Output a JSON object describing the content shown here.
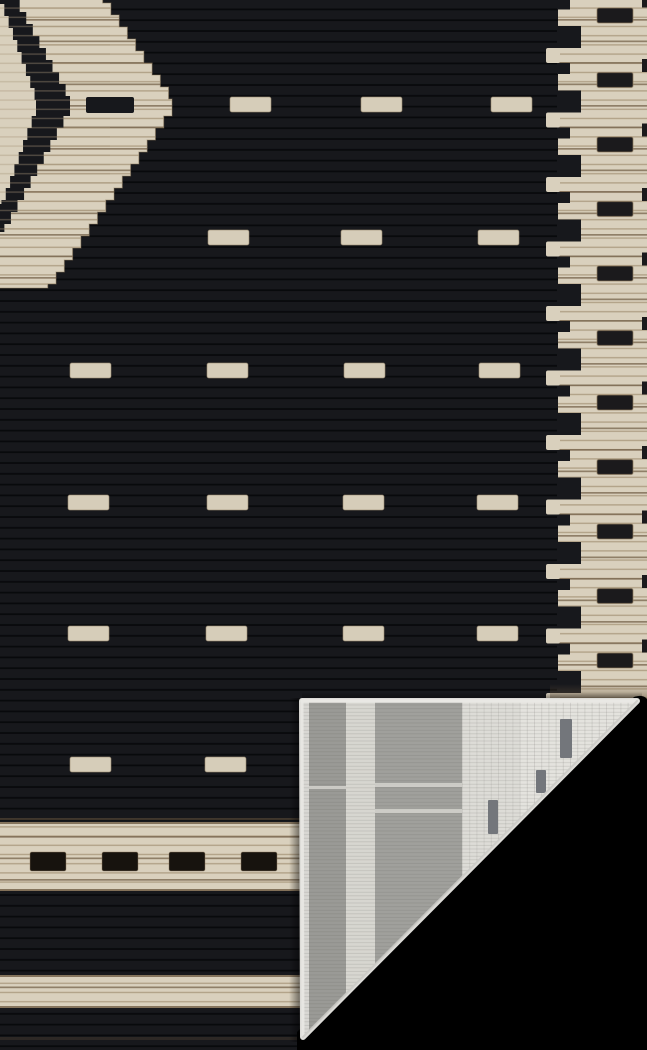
{
  "scene": {
    "type": "product-photo",
    "subject": "Black and cream geometric flat-weave area rug, bottom-right corner folded over revealing gray woven backing on a black floor",
    "background_color": "#000000",
    "image_width": 647,
    "image_height": 1050
  },
  "palette": {
    "field": "#17181c",
    "rib": "#07080a",
    "cream": "#d9d0bd",
    "cream_bright": "#e0d8c6",
    "stitch_light": "#a8967b",
    "stitch_dark": "#6f5d45",
    "border_black": "#1b1a1c",
    "dash_cream": "#d6cdb9",
    "dash_edge": "#9b8a6f",
    "band_dash_black": "#17130e",
    "halo_tan": "#8f7b5e",
    "back_edge": "#e9e8e4",
    "back_gray": "#9a9a96",
    "back_gray_wide": "#a0a09c",
    "back_light": "#d7d6d0",
    "back_white": "#e4e3de",
    "back_grid": "#c6c5c0",
    "back_dark_rect": "#73767b",
    "hyp_edge": "#cbcac6",
    "accent_brown": "#3f372e"
  },
  "field_texture": {
    "rib_spacing": 10.8,
    "rib_thickness": 1.8
  },
  "field_dashes": {
    "size": {
      "w": 41,
      "h": 15
    },
    "rows": [
      {
        "y": 97,
        "xs": [
          230,
          361,
          491
        ]
      },
      {
        "y": 230,
        "xs": [
          208,
          341,
          478
        ]
      },
      {
        "y": 363,
        "xs": [
          70,
          207,
          344,
          479
        ]
      },
      {
        "y": 495,
        "xs": [
          68,
          207,
          343,
          477
        ]
      },
      {
        "y": 626,
        "xs": [
          68,
          206,
          343,
          477
        ]
      },
      {
        "y": 757,
        "xs": [
          70,
          205
        ]
      }
    ]
  },
  "medallion": {
    "step": 12,
    "outer": {
      "cx": 45,
      "cy": 104,
      "rx": 127,
      "ry_top": 185,
      "ry_bottom": 184
    },
    "ring": {
      "cx": 0,
      "cy": 104,
      "rx": 70,
      "ry_top": 128,
      "ry_bottom": 128
    },
    "inner": {
      "cx": 0,
      "cy": 104,
      "rx": 36,
      "ry_top": 100,
      "ry_bottom": 100
    },
    "center_dash": {
      "x": 86,
      "y": 97,
      "w": 48,
      "h": 16
    }
  },
  "right_border": {
    "base_x": 558,
    "right_x": 647,
    "finger_x": 546,
    "unit": 64.5,
    "first_rect_y": 8,
    "units_from": -1,
    "units_to": 10,
    "rect": {
      "x": 597,
      "w": 36,
      "h": 15
    },
    "step_a": {
      "dy": 18,
      "h": 22,
      "to_x": 581
    },
    "finger": {
      "dy": 40,
      "h": 15
    },
    "step_b": {
      "dy": 55,
      "h": 11,
      "to_x": 570
    },
    "edge_sliver": {
      "x": 642,
      "dy": 51,
      "w": 5,
      "h": 13
    },
    "curl_shade_y": 684
  },
  "bottom_border": {
    "band1": {
      "y": 822,
      "h": 69,
      "dash_y": 852,
      "dash_h": 19,
      "dash_w": 36,
      "dash_xs": [
        30,
        102,
        169,
        241
      ]
    },
    "band2": {
      "y": 975,
      "h": 33
    },
    "thin_line_y": 818,
    "accent_line_y": 1037
  },
  "fold": {
    "triangle": [
      [
        302,
        701
      ],
      [
        637,
        701
      ],
      [
        303,
        1037
      ]
    ],
    "stripes": [
      {
        "x": 302,
        "w": 7,
        "color": "#d8d7d3"
      },
      {
        "x": 309,
        "w": 37,
        "color": "#9a9a96"
      },
      {
        "x": 346,
        "w": 29,
        "color": "#d7d6d0"
      },
      {
        "x": 375,
        "w": 87,
        "color": "#a0a09c"
      },
      {
        "x": 462,
        "w": 58,
        "color": "#dddcd7"
      },
      {
        "x": 520,
        "w": 118,
        "color": "#e4e3de"
      }
    ],
    "grid_start_x": 462,
    "grid_end_x": 637,
    "grid_spacing": 7.2,
    "weave_spacing": 3.6,
    "dark_rects": [
      [
        560,
        719,
        12,
        39
      ],
      [
        536,
        770,
        10,
        23
      ],
      [
        488,
        800,
        10,
        34
      ]
    ],
    "streaks": [
      [
        375,
        783,
        87,
        4
      ],
      [
        375,
        809,
        87,
        4
      ],
      [
        309,
        786,
        37,
        3
      ]
    ]
  },
  "floor_cut_path": "M634,697 Q643,694 647,699 L647,1050 L297,1050 L297,1032 Z"
}
